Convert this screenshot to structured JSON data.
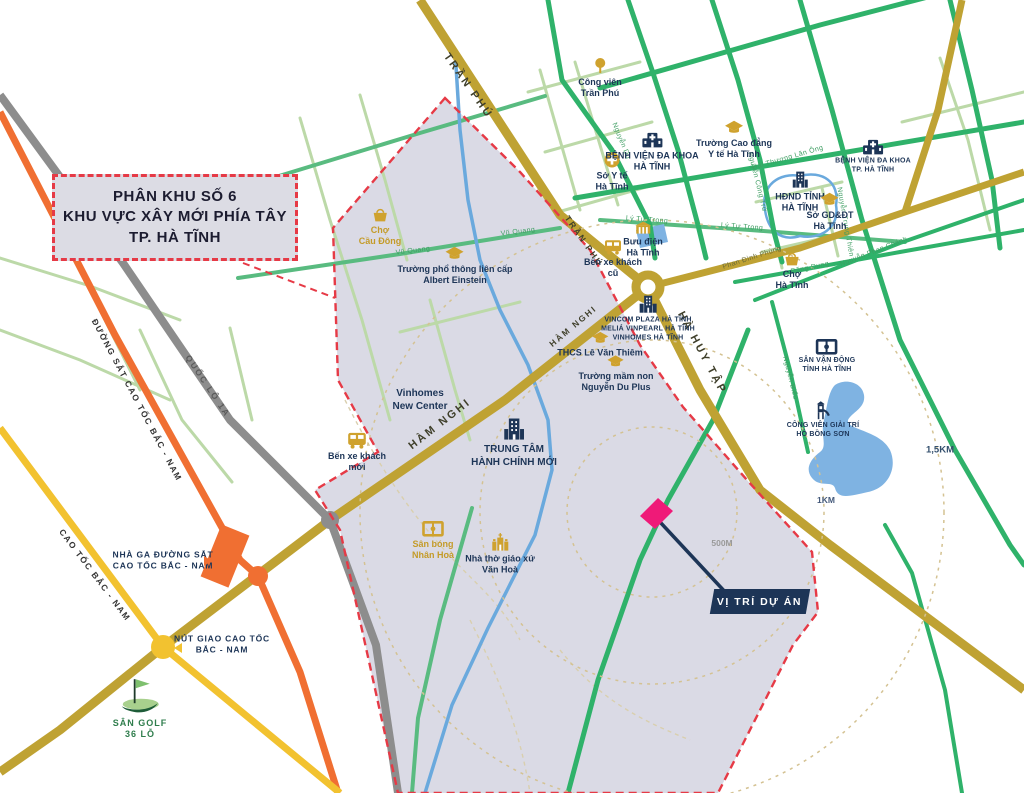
{
  "title_box": {
    "lines": [
      "PHÂN KHU SỐ 6",
      "KHU VỰC XÂY MỚI PHÍA TÂY",
      "TP. HÀ TĨNH"
    ]
  },
  "project_marker": {
    "label": "VỊ TRÍ DỰ ÁN"
  },
  "distance_labels": [
    "500M",
    "1KM",
    "1,5KM"
  ],
  "road_labels": [
    {
      "text": "TRẦN PHÚ"
    },
    {
      "text": "TRẦN PHÚ"
    },
    {
      "text": "HÀM NGHI"
    },
    {
      "text": "HÀM NGHI"
    },
    {
      "text": "HÀ HUY TẬP"
    },
    {
      "text": "QUỐC LỘ 1A"
    },
    {
      "text": "ĐƯỜNG SẮT CAO TỐC BẮC - NAM"
    },
    {
      "text": "CAO TỐC BẮC - NAM"
    },
    {
      "text": "Vũ Quang"
    },
    {
      "text": "Vũ Quang"
    },
    {
      "text": "Hải Thượng Lãn Ông"
    },
    {
      "text": "Lý Tự Trọng"
    },
    {
      "text": "Lý Tự Trọng"
    },
    {
      "text": "Phan Đình Phùng"
    },
    {
      "text": "Đặng Dung"
    },
    {
      "text": "Nguyễn Phan Chánh"
    },
    {
      "text": "Nguyễn Công Trứ"
    },
    {
      "text": "Nguyễn Trung Thiên"
    },
    {
      "text": "Nguyễn Biểu"
    },
    {
      "text": "Nguyễn Du"
    }
  ],
  "pois": [
    {
      "name": "cho-cau-dong",
      "icon": "basket",
      "label": "Chợ\nCầu Đông"
    },
    {
      "name": "truong-albert-einstein",
      "icon": "graduation-cap",
      "label": "Trường phổ thông liên cấp\nAlbert Einstein"
    },
    {
      "name": "cong-vien-tran-phu",
      "icon": "tree",
      "label": "Công viên\nTrần Phú"
    },
    {
      "name": "so-y-te",
      "icon": "medical-cross",
      "label": "Sở Y tế\nHà Tĩnh"
    },
    {
      "name": "benh-vien-da-khoa-ha-tinh",
      "icon": "hospital",
      "label": "BỆNH VIỆN ĐA KHOA\nHÀ TĨNH"
    },
    {
      "name": "truong-cao-dang-y-te",
      "icon": "graduation-cap",
      "label": "Trường Cao đẳng\nY tế Hà Tĩnh"
    },
    {
      "name": "buu-dien-ha-tinh",
      "icon": "post-office",
      "label": "Bưu điện\nHà Tĩnh"
    },
    {
      "name": "ben-xe-khach-cu",
      "icon": "bus",
      "label": "Bến xe khách\ncũ"
    },
    {
      "name": "vincom-plaza",
      "icon": "buildings",
      "label": "VINCOM PLAZA HÀ TĨNH\nMELIÁ VINPEARL HÀ TĨNH\nVINHOMES HÀ TĨNH"
    },
    {
      "name": "thcs-le-van-thiem",
      "icon": "graduation-cap",
      "label": "THCS Lê Văn Thiêm"
    },
    {
      "name": "truong-mam-non-nguyen-du-plus",
      "icon": "graduation-cap",
      "label": "Trường mầm non\nNguyễn Du Plus"
    },
    {
      "name": "hdnd-tinh-ha-tinh",
      "icon": "building",
      "label": "HĐND TỈNH\nHÀ TĨNH"
    },
    {
      "name": "so-gd-dt",
      "icon": "graduation-cap",
      "label": "Sở GD&ĐT\nHà Tĩnh"
    },
    {
      "name": "benh-vien-da-khoa-tp",
      "icon": "hospital",
      "label": "BỆNH VIỆN ĐA KHOA\nTP. HÀ TĨNH"
    },
    {
      "name": "cho-ha-tinh",
      "icon": "basket",
      "label": "Chợ\nHà Tĩnh"
    },
    {
      "name": "san-van-dong",
      "icon": "stadium",
      "label": "SÂN VẬN ĐỘNG\nTỈNH HÀ TĨNH"
    },
    {
      "name": "cong-vien-giai-tri-ho-bong-son",
      "icon": "playground",
      "label": "CÔNG VIÊN GIẢI TRÍ\nHỒ BỒNG SƠN"
    },
    {
      "name": "vinhomes-new-center",
      "icon": null,
      "label": "Vinhomes\nNew Center"
    },
    {
      "name": "trung-tam-hanh-chinh-moi",
      "icon": "building",
      "label": "TRUNG TÂM\nHÀNH CHÍNH MỚI"
    },
    {
      "name": "ben-xe-khach-moi",
      "icon": "bus",
      "label": "Bến xe khách\nmới"
    },
    {
      "name": "san-bong-nhan-hoa",
      "icon": "stadium",
      "label": "Sân bóng\nNhân Hoà"
    },
    {
      "name": "nha-tho-giao-xu-van-hoa",
      "icon": "church",
      "label": "Nhà thờ giáo xứ\nVăn Hoà"
    },
    {
      "name": "nha-ga-duong-sat",
      "icon": null,
      "label": "NHÀ GA ĐƯỜNG SẮT\nCAO TỐC BẮC - NAM"
    },
    {
      "name": "nut-giao-cao-toc",
      "icon": null,
      "label": "NÚT GIAO CAO TỐC\nBẮC - NAM"
    },
    {
      "name": "san-golf",
      "icon": "golf",
      "label": "SÂN GOLF\n36 LỖ"
    }
  ],
  "colors": {
    "zone_fill": "#dadae5",
    "boundary_red": "#e63a46",
    "gold_road": "#bfa233",
    "yellow_road": "#f2c230",
    "orange_rail": "#f06f32",
    "gray_road": "#8d8d8d",
    "green_road": "#2fb26a",
    "light_green_road": "#bcd9a8",
    "water": "#6aa9dd",
    "navy": "#1d3557",
    "gold_icon": "#cfa22e",
    "pink_marker": "#ef1a78",
    "ring": "#d4c292"
  }
}
